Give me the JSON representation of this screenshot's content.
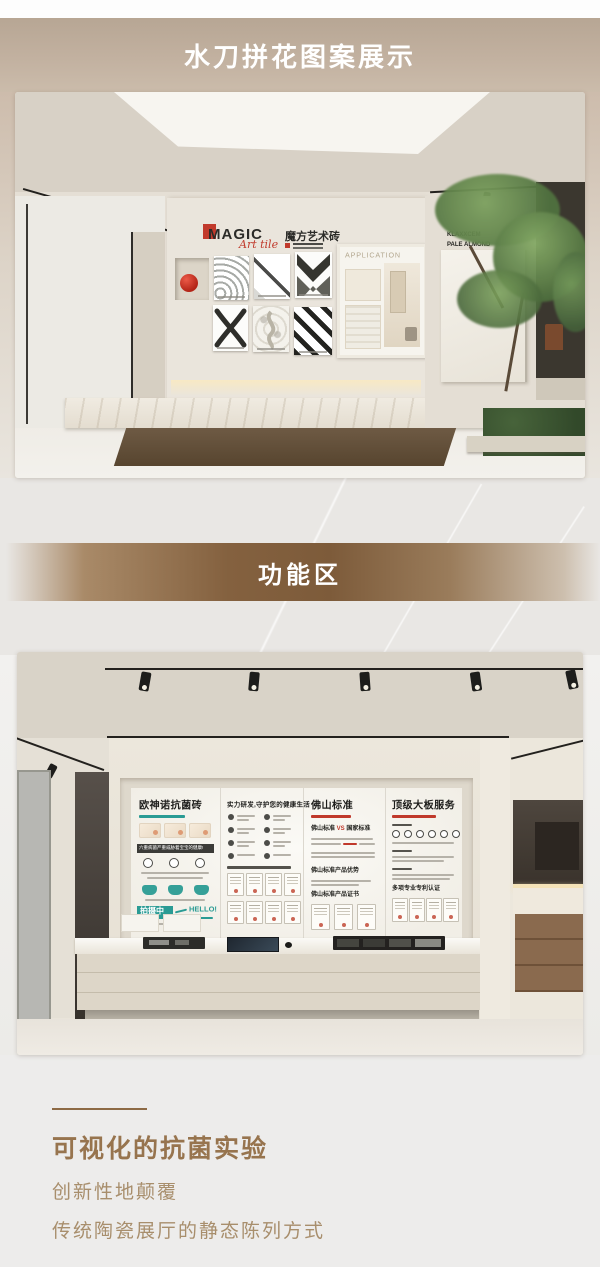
{
  "header": {
    "title": "水刀拼花图案展示"
  },
  "divider": {
    "label": "功能区"
  },
  "photo1": {
    "logo_brand": "MAGIC",
    "logo_script": "Art tile",
    "logo_cn": "魔方艺术砖",
    "application_title": "APPLICATION",
    "wall_label_line1": "KLAXXCEM",
    "wall_label_line2": "PALE ALMOND"
  },
  "photo2": {
    "panels": [
      {
        "title": "欧神诺抗菌砖",
        "banner": "六重病菌严重威胁着宝宝的健康!",
        "badge": "拍摄中",
        "hello": "HELLO!"
      },
      {
        "title": "实力研发,守护您的健康生活"
      },
      {
        "title": "佛山标准",
        "vs_left": "佛山标准",
        "vs": "VS",
        "vs_right": "国家标准",
        "section1": "佛山标准产品优势",
        "section2": "佛山标准产品证书"
      },
      {
        "title": "顶级大板服务",
        "section1": "多项专业专利认证"
      }
    ]
  },
  "footer": {
    "heading": "可视化的抗菌实验",
    "line1": "创新性地颠覆",
    "line2": "传统陶瓷展厅的静态陈列方式"
  },
  "colors": {
    "brand_red": "#c13a2c",
    "teal": "#2a9b94",
    "band_brown": "#84613f",
    "caption_brown": "#97744e",
    "header_tan": "#c0b09e"
  }
}
